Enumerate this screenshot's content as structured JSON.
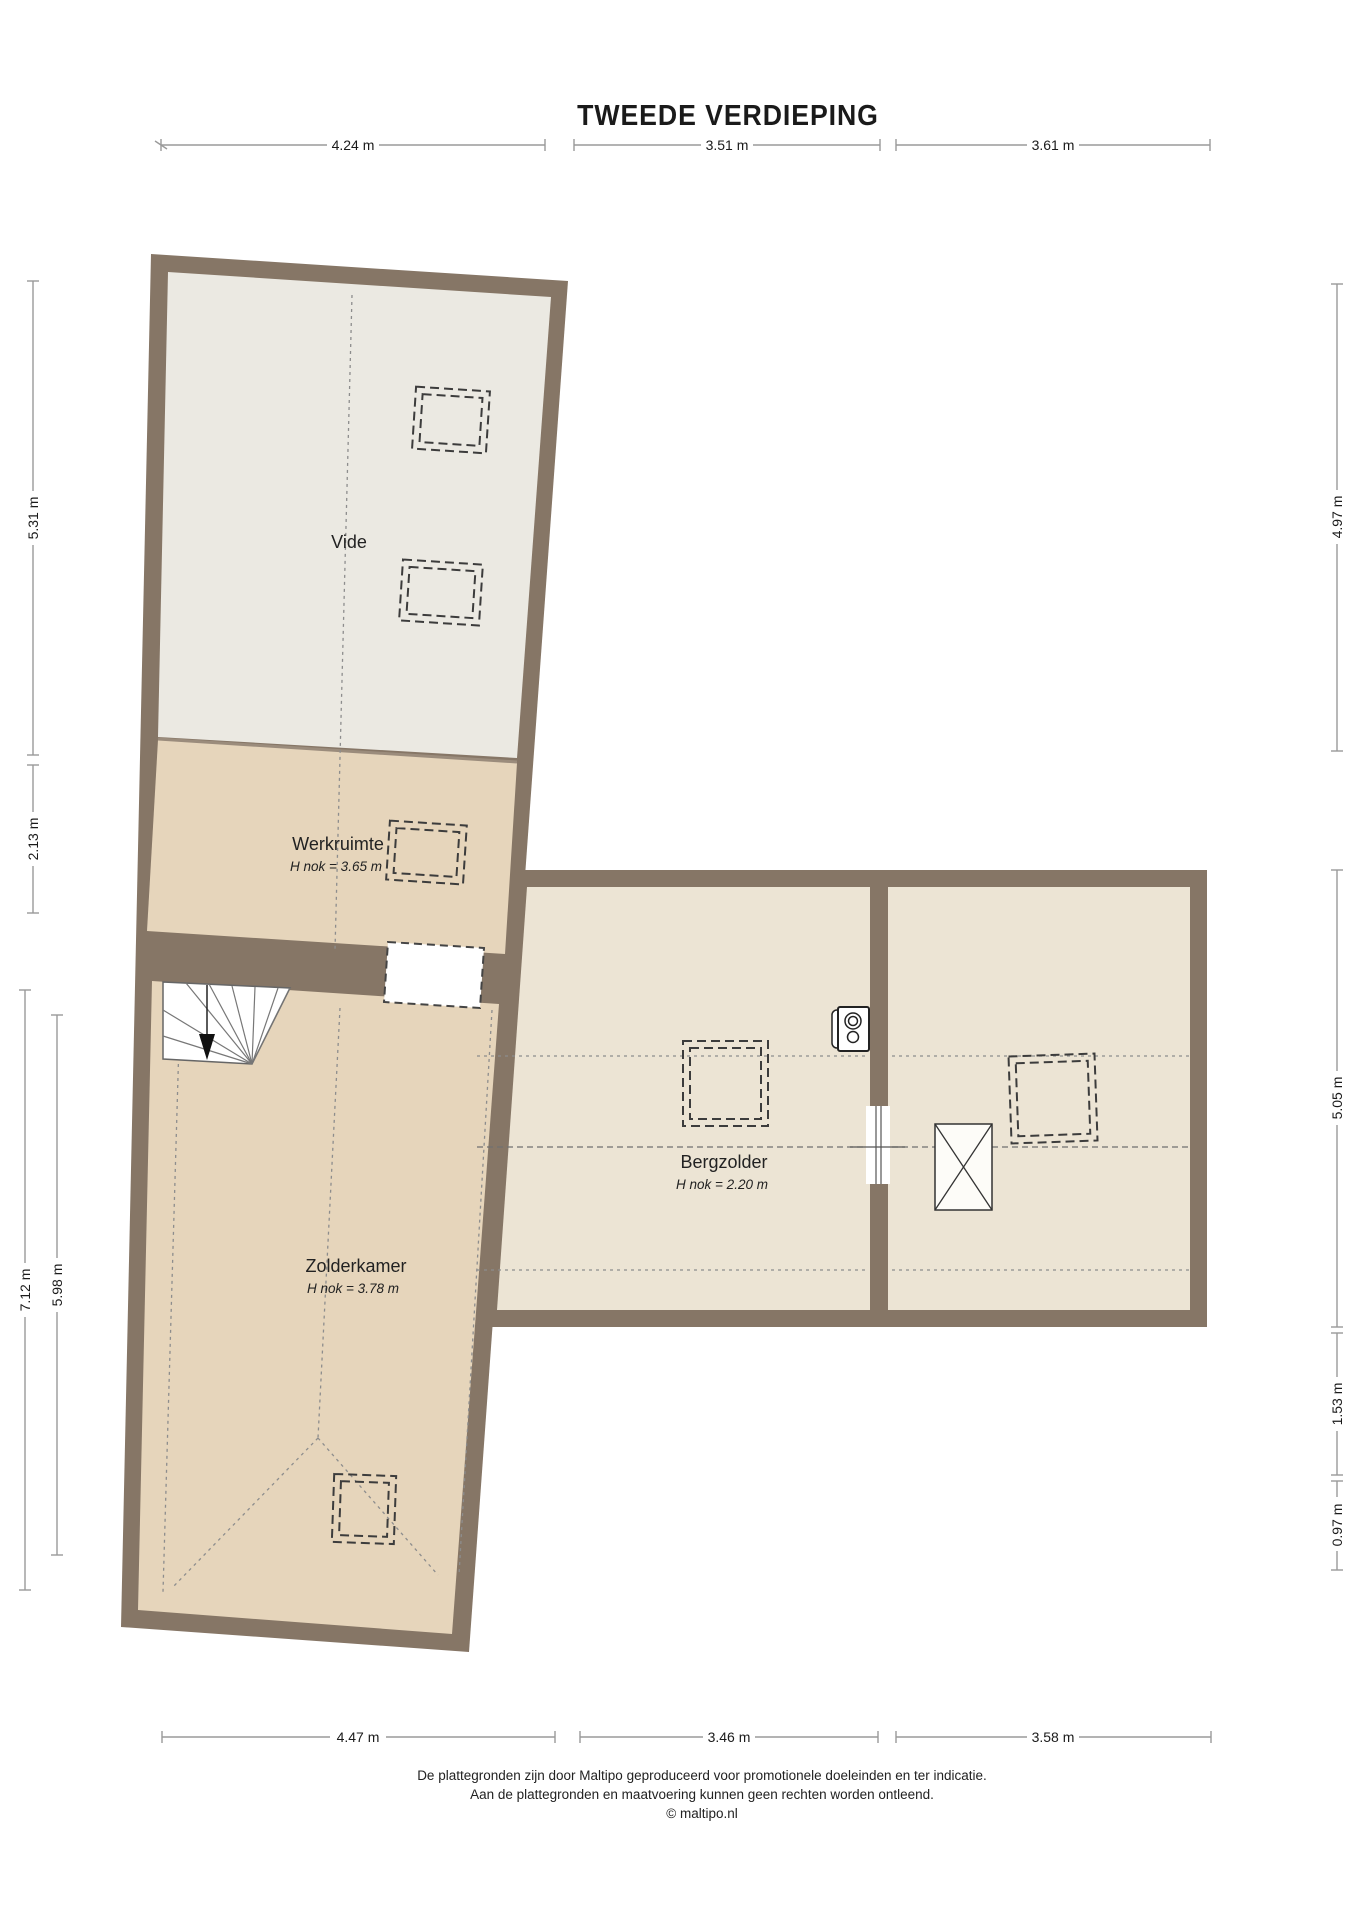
{
  "title": "TWEEDE VERDIEPING",
  "dimensions": {
    "top": [
      "4.24 m",
      "3.51 m",
      "3.61 m"
    ],
    "bottom": [
      "4.47 m",
      "3.46 m",
      "3.58 m"
    ],
    "left": [
      "5.31 m",
      "2.13 m",
      "7.12 m",
      "5.98 m"
    ],
    "right": [
      "4.97 m",
      "5.05 m",
      "1.53 m",
      "0.97 m"
    ]
  },
  "rooms": {
    "vide": {
      "label": "Vide"
    },
    "werkruimte": {
      "label": "Werkruimte",
      "note": "H nok = 3.65 m"
    },
    "zolderkamer": {
      "label": "Zolderkamer",
      "note": "H nok = 3.78 m"
    },
    "bergzolder": {
      "label": "Bergzolder",
      "note": "H nok = 2.20 m"
    }
  },
  "footer": {
    "line1": "De plattegronden zijn door Maltipo geproduceerd voor promotionele doeleinden en ter indicatie.",
    "line2": "Aan de plattegronden en maatvoering kunnen geen rechten worden ontleend.",
    "line3": "© maltipo.nl"
  },
  "icons": {
    "boiler": "cv-boiler-icon",
    "chimney": "chimney-shaft-icon",
    "stairs": "staircase-down-icon",
    "skylight": "skylight-dashed-icon"
  },
  "colors": {
    "wall": "#867666",
    "floor_tan": "#e6d5bb",
    "floor_light": "#ebe9e2",
    "floor_cream": "#ece4d4",
    "dimension_line": "#9a9a9a",
    "text": "#1a1a1a"
  }
}
